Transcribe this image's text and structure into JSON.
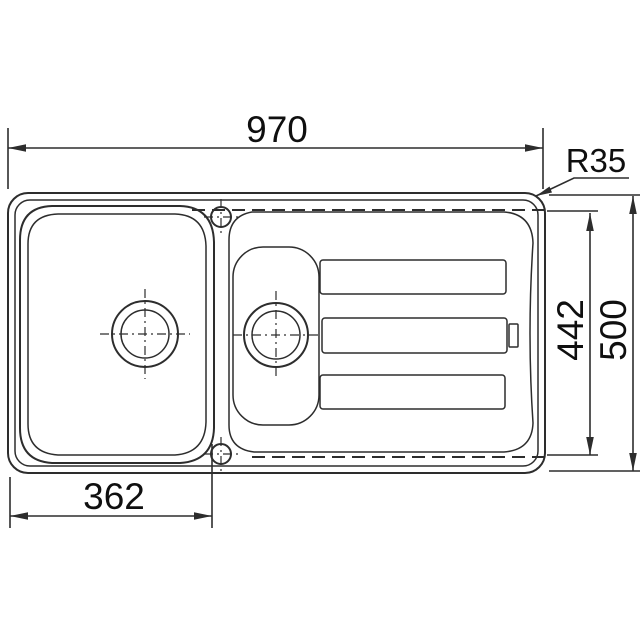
{
  "drawing": {
    "type": "technical-dimension-drawing",
    "subject": "inset kitchen sink with main bowl, half bowl and drainer, top view",
    "labels": {
      "overall_width": "970",
      "corner_radius": "R35",
      "bowl_area_depth": "442",
      "overall_depth": "500",
      "main_bowl_width": "362"
    },
    "colors": {
      "line": "#2d2d2d",
      "text": "#0f0f0f",
      "background": "#ffffff"
    }
  }
}
